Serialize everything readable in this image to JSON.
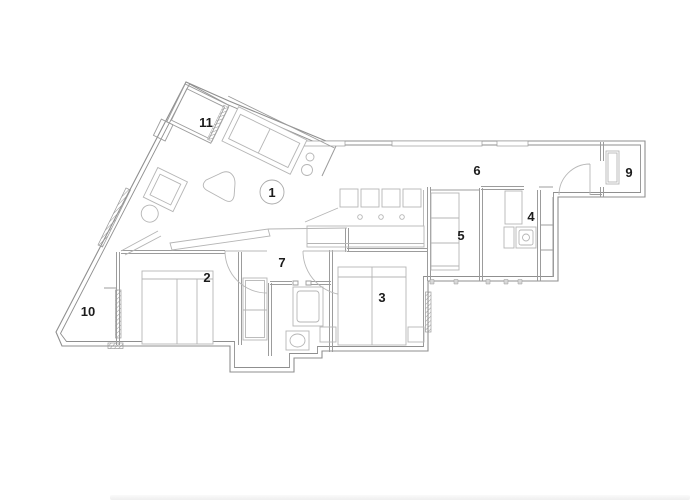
{
  "page": {
    "background": "#ffffff"
  },
  "floor_plan": {
    "type": "apartment-floor-plan",
    "room_labels": [
      {
        "number": "1"
      },
      {
        "number": "2"
      },
      {
        "number": "3"
      },
      {
        "number": "4"
      },
      {
        "number": "5"
      },
      {
        "number": "6"
      },
      {
        "number": "7"
      },
      {
        "number": "9"
      },
      {
        "number": "10"
      },
      {
        "number": "11"
      }
    ],
    "colors": {
      "exterior_wall": "#8f8f8f",
      "interior_wall": "#9c9c9c",
      "furniture_line": "#b5b5b5",
      "label_text": "#1c1c1c",
      "label_circle": "#ababab"
    }
  }
}
